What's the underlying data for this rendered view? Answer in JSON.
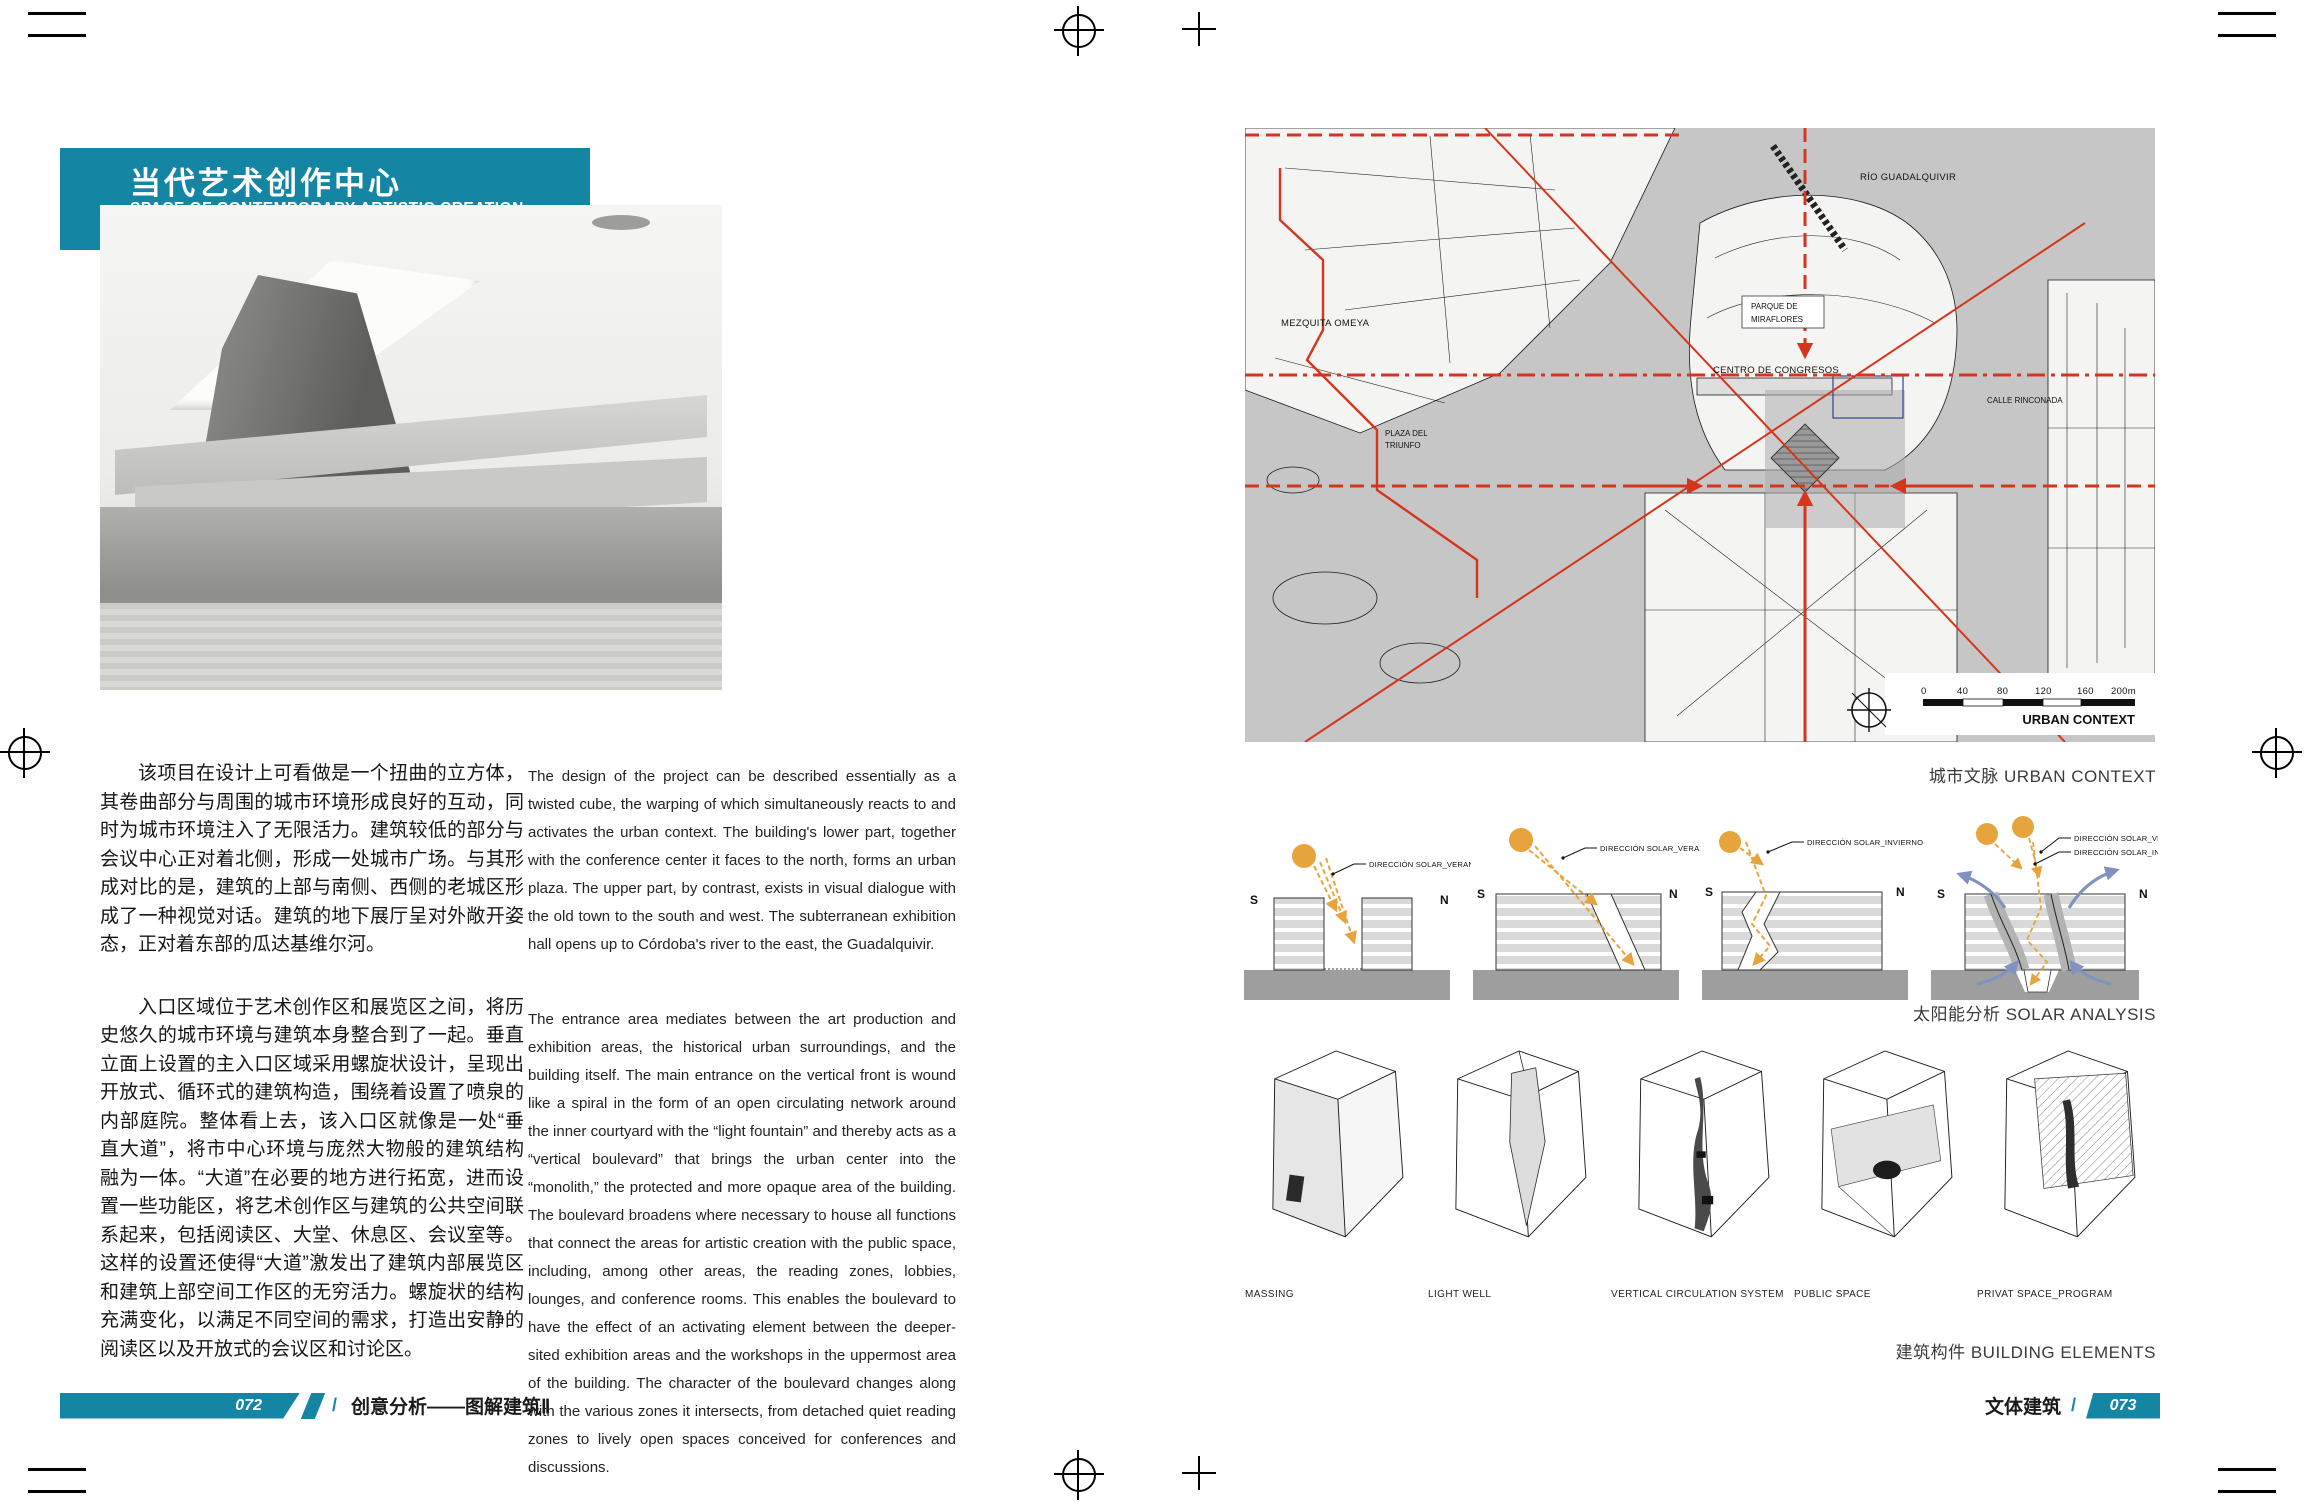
{
  "colors": {
    "teal": "#1585a4",
    "red": "#d5351d",
    "sun": "#e7a43c",
    "wind": "#8093c0"
  },
  "left_page": {
    "title_block": {
      "title_zh": "当代艺术创作中心",
      "title_en": "SPACE OF CONTEMPORARY ARTISTIC CREATION"
    },
    "credits": {
      "row1_label": "设计公司",
      "row1_sep": "/",
      "row1_value": "蓝天组",
      "row2_label": "地点",
      "row2_sep": "/",
      "row2_value": "西班牙，科尔多瓦"
    },
    "zh_paragraphs": [
      "该项目在设计上可看做是一个扭曲的立方体，其卷曲部分与周围的城市环境形成良好的互动，同时为城市环境注入了无限活力。建筑较低的部分与会议中心正对着北侧，形成一处城市广场。与其形成对比的是，建筑的上部与南侧、西侧的老城区形成了一种视觉对话。建筑的地下展厅呈对外敞开姿态，正对着东部的瓜达基维尔河。",
      "入口区域位于艺术创作区和展览区之间，将历史悠久的城市环境与建筑本身整合到了一起。垂直立面上设置的主入口区域采用螺旋状设计，呈现出开放式、循环式的建筑构造，围绕着设置了喷泉的内部庭院。整体看上去，该入口区就像是一处“垂直大道”，将市中心环境与庞然大物般的建筑结构融为一体。“大道”在必要的地方进行拓宽，进而设置一些功能区，将艺术创作区与建筑的公共空间联系起来，包括阅读区、大堂、休息区、会议室等。这样的设置还使得“大道”激发出了建筑内部展览区和建筑上部空间工作区的无穷活力。螺旋状的结构充满变化，以满足不同空间的需求，打造出安静的阅读区以及开放式的会议区和讨论区。"
    ],
    "en_paragraphs": [
      "The design of the project can be described essentially as a twisted cube, the warping of which simultaneously reacts to and activates the urban context. The building's lower part, together with the conference center it faces to the north, forms an urban plaza. The upper part, by contrast, exists in visual dialogue with the old town to the south and west. The subterranean exhibition hall opens up to Córdoba's river to the east, the Guadalquivir.",
      "The entrance area mediates between the art production and exhibition areas, the historical urban surroundings, and the building itself. The main entrance on the vertical front is wound like a spiral in the form of an open circulating network around the inner courtyard with the “light fountain” and thereby acts as a “vertical boulevard” that brings the urban center into the “monolith,” the protected and more opaque area of the building. The boulevard broadens where necessary to house all functions that connect the areas for artistic creation with the public space, including, among other areas, the reading zones, lobbies, lounges, and conference rooms. This enables the boulevard to have the effect of an activating element between the deeper-sited exhibition areas and the workshops in the uppermost area of the building. The character of the boulevard changes along with the various zones it intersects, from detached quiet reading zones to lively open spaces conceived for conferences and discussions."
    ],
    "footer": {
      "page_no": "072",
      "sep": "/",
      "book_title": "创意分析——图解建筑Ⅱ"
    }
  },
  "right_page": {
    "urban_context": {
      "caption": "城市文脉 URBAN CONTEXT",
      "labels": {
        "river": "RÍO GUADALQUIVIR",
        "mezquita": "MEZQUITA OMEYA",
        "parque_line1": "PARQUE DE",
        "parque_line2": "MIRAFLORES",
        "congresos": "CENTRO DE CONGRESOS",
        "plaza_line1": "PLAZA DEL",
        "plaza_line2": "TRIUNFO",
        "calle": "CALLE RINCONADA"
      },
      "scale": {
        "t0": "0",
        "t40": "40",
        "t80": "80",
        "t120": "120",
        "t160": "160",
        "t200": "200m",
        "label": "URBAN CONTEXT"
      }
    },
    "solar": {
      "caption": "太阳能分析 SOLAR ANALYSIS",
      "south": "S",
      "north": "N",
      "verano": "DIRECCIÓN SOLAR_VERANO",
      "invierno": "DIRECCIÓN SOLAR_INVIERNO"
    },
    "elements": {
      "caption": "建筑构件 BUILDING ELEMENTS",
      "labels": [
        "MASSING",
        "LIGHT WELL",
        "VERTICAL CIRCULATION SYSTEM",
        "PUBLIC SPACE",
        "PRIVAT SPACE_PROGRAM"
      ]
    },
    "footer": {
      "category": "文体建筑",
      "sep": "/",
      "page_no": "073"
    }
  }
}
